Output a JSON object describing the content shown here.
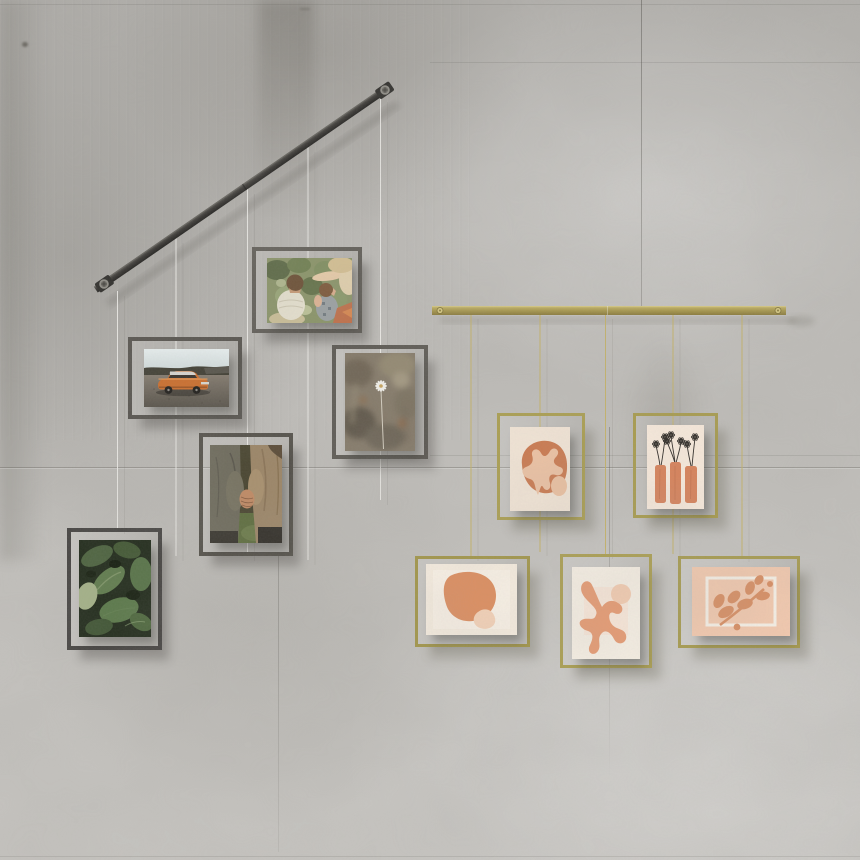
{
  "page": {
    "title": "Two hanging frame displays on a concrete wall"
  },
  "wall": {
    "material": "concrete",
    "base_color": "#c0beba",
    "seam_color": "#55534c"
  },
  "left_display": {
    "id": "black-steel-display",
    "rail": {
      "style": "diagonal",
      "color": "#33312e",
      "mount_count": 2
    },
    "wire_color": "#efeeea",
    "frame_color": "#56534d",
    "frame_count": 5,
    "frames": [
      {
        "id": "kids-garden",
        "orientation": "landscape",
        "subject": "Three children playing among garden plants, viewed from above"
      },
      {
        "id": "vintage-car",
        "orientation": "landscape",
        "subject": "Orange vintage sedan parked on gravel below dark hills"
      },
      {
        "id": "white-daisy",
        "orientation": "portrait",
        "subject": "Single white daisy on a blurred olive-brown field"
      },
      {
        "id": "holding-hands",
        "orientation": "portrait",
        "subject": "Two people in jackets holding hands over green grass"
      },
      {
        "id": "green-leaves",
        "orientation": "portrait",
        "subject": "Close-up of dark green leaves"
      }
    ]
  },
  "right_display": {
    "id": "brass-display",
    "rail": {
      "style": "horizontal",
      "color": "#a6954a",
      "mount_count": 2
    },
    "wire_color": "#c2b060",
    "frame_color": "#a89c4f",
    "frame_count": 5,
    "art_palette": {
      "terracotta": "#cd7c52",
      "peach": "#eec3a4",
      "cream": "#f4e9da",
      "blush": "#f4cbb0",
      "ink": "#2d2925"
    },
    "frames": [
      {
        "id": "abstract-coral-over-blob",
        "orientation": "portrait",
        "subject": "Abstract print of a light coral shape over a terracotta blob"
      },
      {
        "id": "flower-vases",
        "orientation": "portrait",
        "subject": "Print of black sketched daisies in three terracotta vases"
      },
      {
        "id": "abstract-stones",
        "orientation": "landscape",
        "subject": "Abstract print of a large terracotta blob with a small peach stone"
      },
      {
        "id": "coral-branch",
        "orientation": "portrait",
        "subject": "Abstract print of a terracotta coral branch with a peach circle"
      },
      {
        "id": "leaf-sprig",
        "orientation": "landscape",
        "subject": "Print of a terracotta leaf sprig in a white outlined box on blush"
      }
    ]
  }
}
